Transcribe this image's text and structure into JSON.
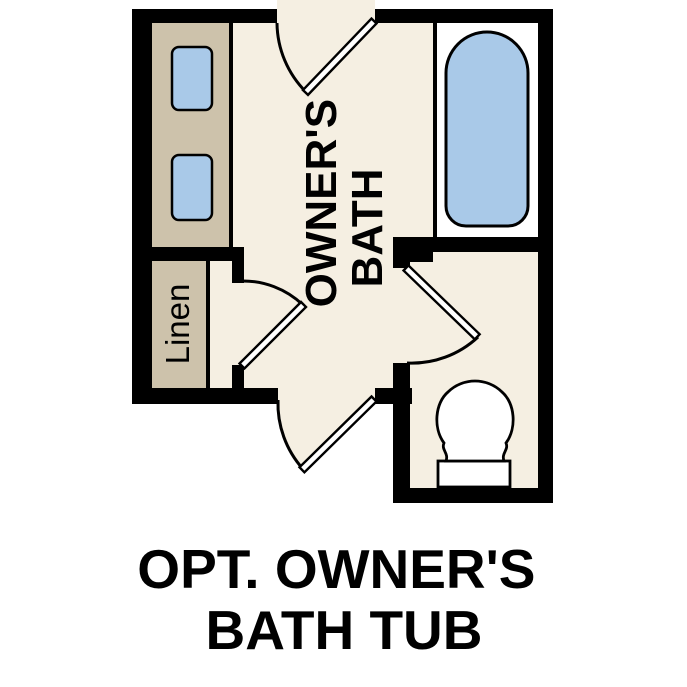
{
  "plan": {
    "room_label": {
      "line1": "OWNER'S",
      "line2": "BATH"
    },
    "linen_label": "Linen"
  },
  "caption": {
    "line1": "OPT. OWNER'S",
    "line2": "BATH TUB"
  },
  "colors": {
    "wall": "#000000",
    "floor": "#f5efe2",
    "cabinet": "#cdc2ab",
    "fixture_blue": "#a9c9e8",
    "fixture_white": "#ffffff",
    "alcove_floor": "#ffffff",
    "text": "#000000",
    "background": "#ffffff"
  }
}
